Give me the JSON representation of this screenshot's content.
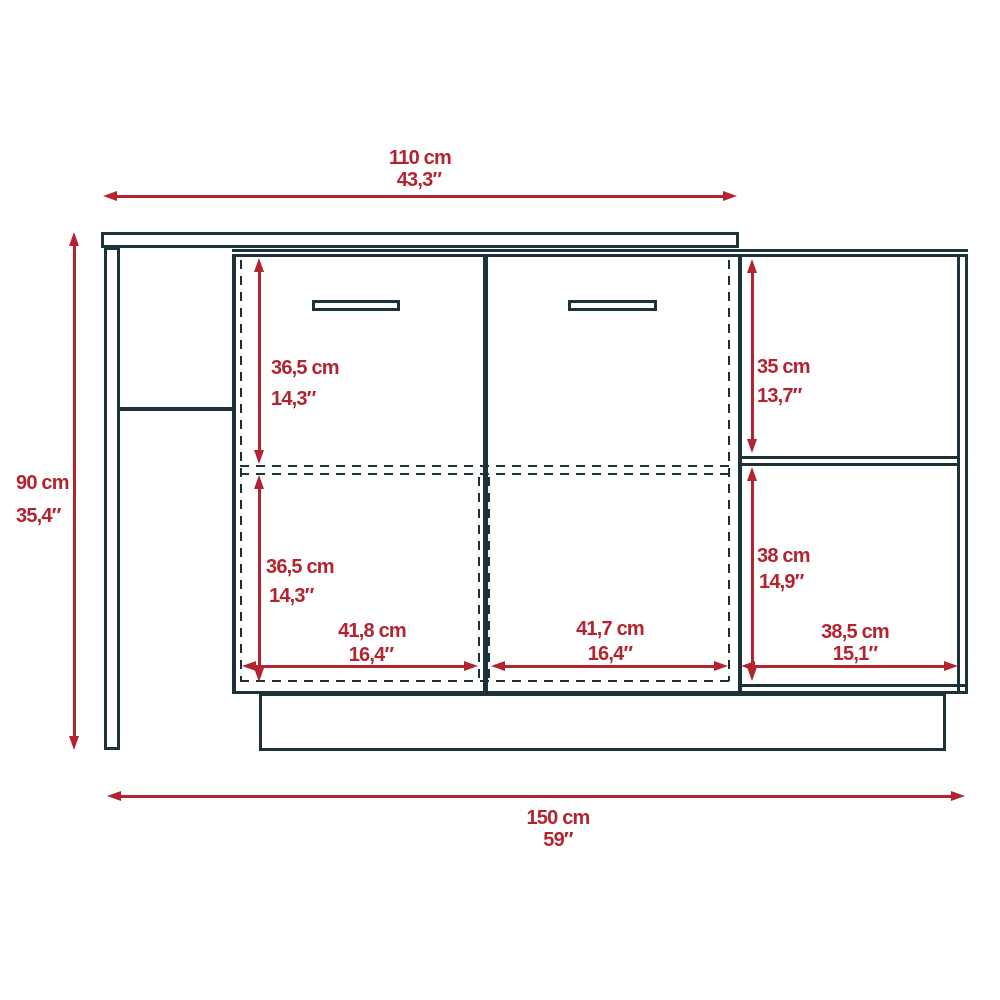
{
  "style": {
    "line_color": "#1c3238",
    "dimension_color": "#b32430",
    "background": "#ffffff"
  },
  "drawing": {
    "type": "furniture-dimension-diagram",
    "units": [
      "cm",
      "inch"
    ]
  },
  "dimensions": {
    "top_width": {
      "cm": "110 cm",
      "inch": "43,3″"
    },
    "height": {
      "cm": "90 cm",
      "inch": "35,4″"
    },
    "bottom_width": {
      "cm": "150 cm",
      "inch": "59″"
    },
    "center_upper_height": {
      "cm": "36,5 cm",
      "inch": "14,3″"
    },
    "center_lower_height": {
      "cm": "36,5 cm",
      "inch": "14,3″"
    },
    "right_upper_height": {
      "cm": "35 cm",
      "inch": "13,7″"
    },
    "right_lower_height": {
      "cm": "38 cm",
      "inch": "14,9″"
    },
    "left_door_width": {
      "cm": "41,8 cm",
      "inch": "16,4″"
    },
    "right_door_width": {
      "cm": "41,7 cm",
      "inch": "16,4″"
    },
    "right_shelf_width": {
      "cm": "38,5 cm",
      "inch": "15,1″"
    }
  }
}
